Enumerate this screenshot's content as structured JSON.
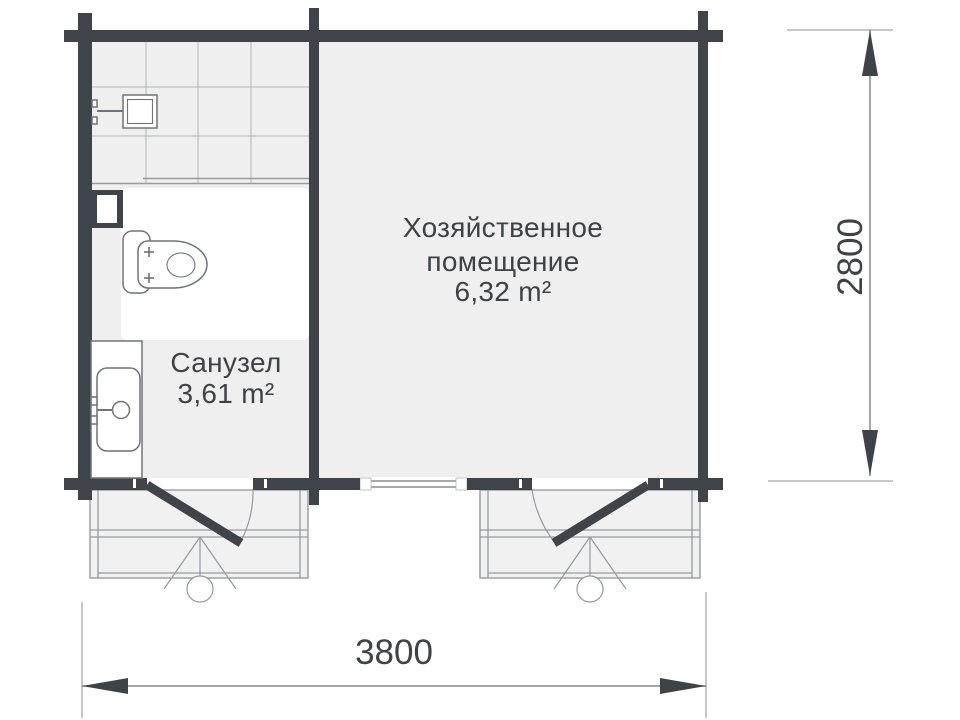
{
  "rooms": {
    "utility": {
      "name_line1": "Хозяйственное",
      "name_line2": "помещение",
      "area": "6,32 m²"
    },
    "bathroom": {
      "name": "Санузел",
      "area": "3,61 m²"
    }
  },
  "dimensions": {
    "width_mm": "3800",
    "height_mm": "2800"
  },
  "colors": {
    "wall": "#3f444b",
    "room-fill": "#efeff0",
    "porch-fill": "#f1f1f2",
    "grid": "#b0b4b8",
    "line-gray": "#969ba1",
    "fixture": "#6e747b",
    "text": "#3d4248",
    "dim-line": "#85898e",
    "dim-text": "#3e4347",
    "ext-line": "#b2b5b8"
  }
}
